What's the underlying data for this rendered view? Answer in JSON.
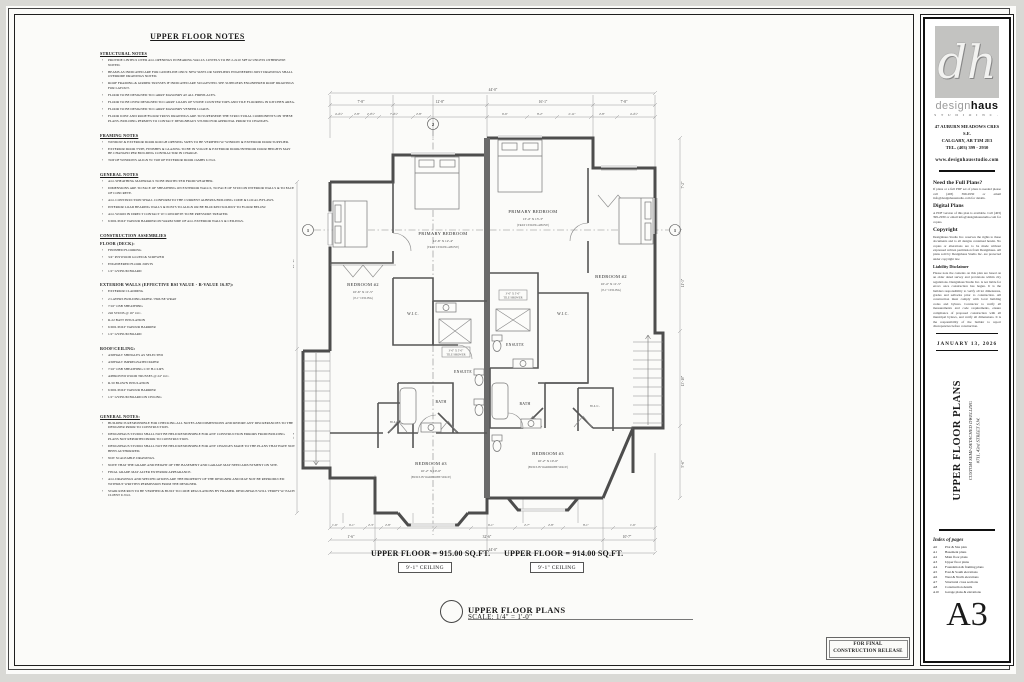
{
  "sheet": {
    "number": "A3",
    "date": "JANUARY 13, 2026",
    "release_line1": "FOR FINAL",
    "release_line2": "CONSTRUCTION RELEASE"
  },
  "brand": {
    "logo_text": "dh",
    "name_light": "design",
    "name_bold": "haus",
    "tagline": "S T U D I O   I N C .",
    "address1": "47 AUBURN MEADOWS CRES S.E.",
    "address2": "CALGARY, AB    T3M 2E3",
    "address3": "TEL. (403) 399 - 2930",
    "website": "www.designhausstudio.com"
  },
  "titleblock": {
    "sections": [
      {
        "heading": "Need the Full Plans?",
        "body": "If plans or a full PDF set of plans is needed please call (403) 399-2930 or email info@designhausstudio.com for details."
      },
      {
        "heading": "Digital Plans",
        "body": "A PDF version of this plan is available. Call (403) 399-2930 or email info@designhausstudio.com for copies."
      },
      {
        "heading": "Copyright",
        "body": "Designhaus Studio Inc. reserves the rights to these documents and to all designs contained herein. No copies or alterations are to be made without expressed written permission from Designhaus. All plans sold by Designhaus Studio Inc. are protected under copyright law."
      },
      {
        "heading": "Liability Disclaimer",
        "body": "Please note the contents on this plan are based on an older dated survey and provisions within city regulations. Designhaus Studio Inc. is not liable for errors once construction has begun. It is the builders responsibility to verify all lot dimensions, grades and setbacks prior to construction. All construction must comply with local building codes and bylaws. Contractor to verify all measurements and code requirements, ensure compliance of proposed construction with all municipal bylaws, and verify all dimensions. It is the responsibility of the builder to report discrepancies before construction."
      }
    ],
    "project_title": "UPPER FLOOR PLANS",
    "project_sub1": "CUSTOM SEMI-DETACHED DWELLING",
    "project_sub2": "#711, 43rd STREET S.W.",
    "index_heading": "Index of pages",
    "index": [
      {
        "no": "A0",
        "t": "Plot & Site plan"
      },
      {
        "no": "A1",
        "t": "Basement plans"
      },
      {
        "no": "A2",
        "t": "Main floor plans"
      },
      {
        "no": "A3",
        "t": "Upper floor plans"
      },
      {
        "no": "A4",
        "t": "Foundation & framing plans"
      },
      {
        "no": "A5",
        "t": "East & South elevations"
      },
      {
        "no": "A6",
        "t": "West & North elevations"
      },
      {
        "no": "A7",
        "t": "Structural cross sections"
      },
      {
        "no": "A8",
        "t": "Construction details"
      },
      {
        "no": "A10",
        "t": "Garage plans & elevations"
      }
    ]
  },
  "notes": {
    "title": "UPPER FLOOR NOTES",
    "sections": [
      {
        "heading": "STRUCTURAL NOTES",
        "items": [
          "PROVIDE LINTELS OVER ALL OPENINGS IN BEARING WALLS. LINTELS TO BE 2-2x10 SPF #2 UNLESS OTHERWISE NOTED.",
          "BEAMS AS INDICATED ARE FOR GUIDELINE ONLY. NEW SIZES OR SUPPLIERS ENGINEERED JOIST DRAWINGS SHALL OVERRIDE DRAWINGS NOTED.",
          "ROOF FRAMING & GIRDER TRUSSES IF INDICATED ARE SUGGESTED. SEE SUPPLIERS ENGINEERED ROOF DRAWINGS FOR LAYOUT.",
          "FLOOR TO BE DESIGNED TO CARRY MASONRY AT ALL FIREPLACES.",
          "FLOOR TO BE OVER DESIGNED TO CARRY LOADS OF STONE COUNTER TOPS AND TILE FLOORING IN KITCHEN AREA.",
          "FLOOR TO BE DESIGNED TO CARRY MASONRY VENEER LOADS.",
          "FLOOR JOIST AND ROOF/FLOOR TRUSS DRAWINGS ARE TO SUPERSEDE THE STRUCTURAL COMPONENTS ON THESE PLANS. BUILDING PERMITS TO CONTACT DESIGNHAUS STUDIO FOR APPROVAL PRIOR TO CHANGES."
        ]
      },
      {
        "heading": "FRAMING NOTES",
        "items": [
          "WINDOW & EXTERIOR DOOR ROUGH OPENING SIZES TO BE VERIFIED W/ WINDOW & EXTERIOR DOOR SUPPLIER.",
          "EXTERIOR DOOR TYPE, FINISHES & GLAZING TO BE IN VOGUE & EXTERIOR DOOR/INTERIOR DOOR HEIGHTS MAY BE CHANGED PER BUILDING CONTRACTOR IN CHARGE.",
          "TOP OF WINDOWS ALIGN W/ TOP OF EXTERIOR DOOR JAMBS U.N.O."
        ]
      },
      {
        "heading": "GENERAL NOTES",
        "items": [
          "ALL SHEATHING MATERIALS TO BE PROTECTED FROM WEATHER.",
          "DIMENSIONS ARE TO FACE OF SHEATHING ON EXTERIOR WALLS, TO FACE OF STUD ON INTERIOR WALLS & TO FACE OF CONCRETE.",
          "ALL CONSTRUCTION SHALL CONFORM TO THE CURRENT ALBERTA BUILDING CODE & LOCAL BYLAWS.",
          "INTERIOR LOAD BEARING WALLS & POSTS TO ALIGN OR BE BLOCKED SOLIDLY TO FLOOR BELOW.",
          "ALL WOOD IN DIRECT CONTACT W/ CONCRETE TO BE PRESSURE TREATED.",
          "6 MIL POLY VAPOUR BARRIER ON WARM SIDE OF ALL EXTERIOR WALLS & CEILINGS."
        ]
      },
      {
        "heading": "CONSTRUCTION ASSEMBLIES",
        "items": []
      },
      {
        "heading": "FLOOR (DECK):",
        "items": [
          "FINISHED FLOORING",
          "3/4\" PLYWOOD GLUED & SCREWED",
          "ENGINEERED FLOOR JOISTS",
          "1/2\" GYPSUM BOARD"
        ]
      },
      {
        "heading": "EXTERIOR WALLS (EFFECTIVE RSI VALUE - R-VALUE 16.87):",
        "items": [
          "EXTERIOR CLADDING",
          "2 LAYERS BUILDING PAPER / HOUSE WRAP",
          "7/16\" OSB SHEATHING",
          "2x6 STUDS @ 16\" O.C.",
          "R-22 BATT INSULATION",
          "6 MIL POLY VAPOUR BARRIER",
          "1/2\" GYPSUM BOARD"
        ]
      },
      {
        "heading": "ROOF/CEILING:",
        "items": [
          "ASPHALT SHINGLES AS SELECTED",
          "ASPHALT IMPREGNATED PAPER",
          "7/16\" OSB SHEATHING C/W H-CLIPS",
          "APPROVED WOOD TRUSSES @ 24\" O.C.",
          "R-50 BLOWN INSULATION",
          "6 MIL POLY VAPOUR BARRIER",
          "1/2\" GYPSUM BOARD ON CEILING"
        ]
      },
      {
        "heading": "GENERAL NOTES:",
        "items": [
          "BUILDER IS RESPONSIBLE FOR CHECKING ALL NOTES AND DIMENSIONS AND REPORT ANY DISCREPANCIES TO THE DESIGNER PRIOR TO CONSTRUCTION.",
          "DESIGNHAUS STUDIO SHALL NOT BE HELD RESPONSIBLE FOR ANY CONSTRUCTION ERRORS FROM BUILDING PLANS NOT REPORTED PRIOR TO CONSTRUCTION.",
          "DESIGNHAUS STUDIO SHALL NOT BE HELD RESPONSIBLE FOR ANY CHANGES MADE TO THE PLANS THAT HAVE NOT BEEN AUTHORIZED.",
          "NOT SCALEABLE DRAWINGS.",
          "NOTE THAT THE GRADE AND HEIGHT OF THE BASEMENT AND GARAGE MAY NEED ADJUSTMENT ON SITE.",
          "FINAL GRADE MAY ALTER EXTERIOR APPEARANCE.",
          "ALL DRAWINGS AND SPECIFICATIONS ARE THE PROPERTY OF THE DESIGNER AND MAY NOT BE REPRODUCED WITHOUT WRITTEN PERMISSION FROM THE DESIGNER.",
          "STAIR RISE/RUN TO BE VERIFIED & BUILT TO CODE REGULATIONS BY FRAMER. DESIGNHAUS WILL VERIFY W/ EACH CLIENT U.N.O."
        ]
      }
    ]
  },
  "plan": {
    "rooms": {
      "b2l_name": "BEDROOM #2",
      "b2l_dims": "10'-6\" X 11'-5\"",
      "b2l_sub": "(9'-1\" CEILING)",
      "pbl_name": "PRIMARY BEDROOM",
      "pbl_dims": "12'-6\" X 12'-4\"",
      "pbl_sub": "(TRAY CEILING ABOVE)",
      "pbr_name": "PRIMARY BEDROOM",
      "pbr_dims": "13'-4\" X 13'-3\"",
      "pbr_sub": "(TRAY CEILING ABOVE)",
      "b2r_name": "BEDROOM #2",
      "b2r_dims": "10'-4\" X 11'-5\"",
      "b2r_sub": "(9'-1\" CEILING)",
      "ens_l": "ENSUITE",
      "ens_r": "ENSUITE",
      "wic_l": "W.I.C.",
      "wic_r": "W.I.C.",
      "wic_bl": "W.I.C.",
      "wic_br": "W.I.C.",
      "bath_l": "BATH",
      "bath_r": "BATH",
      "b3l_name": "BEDROOM #3",
      "b3l_dims": "10'-2\" X 10'-6\"",
      "b3l_sub": "(BUILT-IN WARDROBE SPACE)",
      "b3r_name": "BEDROOM #3",
      "b3r_dims": "10'-2\" X 10'-6\"",
      "b3r_sub": "(BUILT-IN WARDROBE SPACE)",
      "shower_size_l": "3'-0\" X 5'-0\"",
      "shower_word_l": "TILE SHOWER",
      "shower_size_r": "3'-0\" X 5'-0\"",
      "shower_word_r": "TILE SHOWER"
    },
    "markers": {
      "top": "2",
      "left": "1",
      "right": "1"
    },
    "dims": {
      "overall_top": "44'-0\"",
      "overall_bottom": "44'-0\"",
      "t2": [
        "7'-8\"",
        "12'-8\"",
        "16'-1\"",
        "7'-8\""
      ],
      "t3": [
        "4'-4½\"",
        "2'-8\"",
        "2'-0½\"",
        "7'-4½\"",
        "2'-8\"",
        "6'-6\"",
        "8'-2\"",
        "2'-11\"",
        "2'-8\"",
        "4'-4½\""
      ],
      "b1": [
        "1'-6\"",
        "6'-1\"",
        "2'-3\"",
        "2'-8\"",
        "8'-0\"",
        "5'-2\"",
        "6'-1\"",
        "2'-7\"",
        "2'-8\"",
        "8'-1\"",
        "1'-6\""
      ],
      "b2": [
        "1'-6\"",
        "32'-6\"",
        "10'-7\""
      ],
      "right": [
        "7'-2\"",
        "11'-3\"",
        "13'-10\"",
        "5'-6\""
      ],
      "left": [
        "16'-10\"",
        "8'-4\""
      ]
    },
    "areas": {
      "left": "UPPER FLOOR = 915.00 SQ.FT.",
      "right": "UPPER FLOOR = 914.00 SQ.FT.",
      "ceiling_left": "9'-1\" CEILING",
      "ceiling_right": "9'-1\" CEILING"
    },
    "title": "UPPER FLOOR PLANS",
    "scale": "SCALE:  1/4\" = 1'-0\""
  }
}
